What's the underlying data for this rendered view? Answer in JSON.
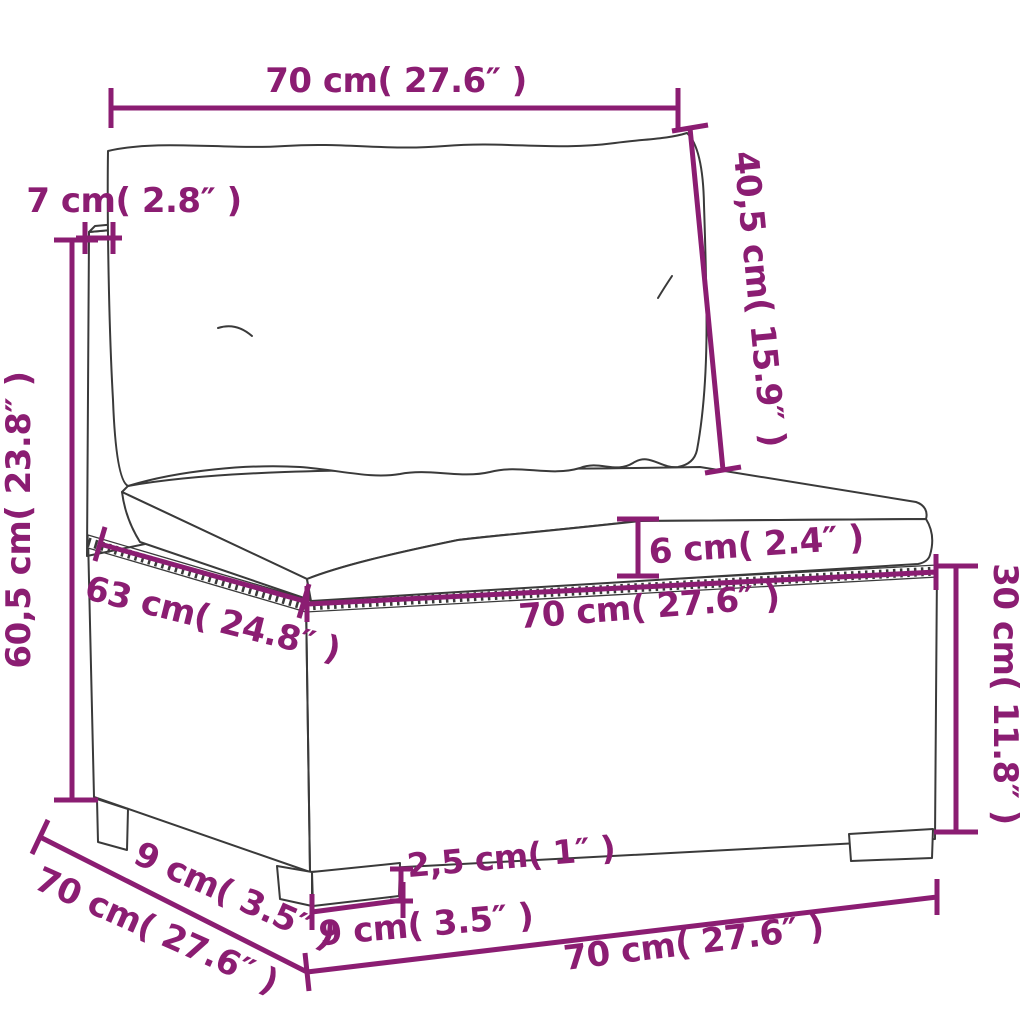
{
  "diagram": {
    "type": "product-dimension-diagram",
    "subject": "poly rattan garden middle sofa with back cushion and seat cushion",
    "accent_color": "#8b1d72",
    "line_color": "#3a3a3a",
    "dimensions": {
      "cushion_width_top": "70 cm( 27.6″ )",
      "back_cushion_height": "40,5 cm( 15.9″ )",
      "frame_thickness": "7 cm( 2.8″ )",
      "total_height": "60,5 cm( 23.8″ )",
      "seat_cushion_thickness": "6 cm( 2.4″ )",
      "seat_depth": "63 cm( 24.8″ )",
      "seat_width": "70 cm( 27.6″ )",
      "base_height": "30 cm( 11.8″ )",
      "leg_height": "2,5 cm( 1″ )",
      "leg_width_front": "9 cm( 3.5″ )",
      "leg_depth_side": "9 cm( 3.5″ )",
      "total_depth": "70 cm( 27.6″ )",
      "total_width_bottom": "70 cm( 27.6″ )"
    }
  }
}
